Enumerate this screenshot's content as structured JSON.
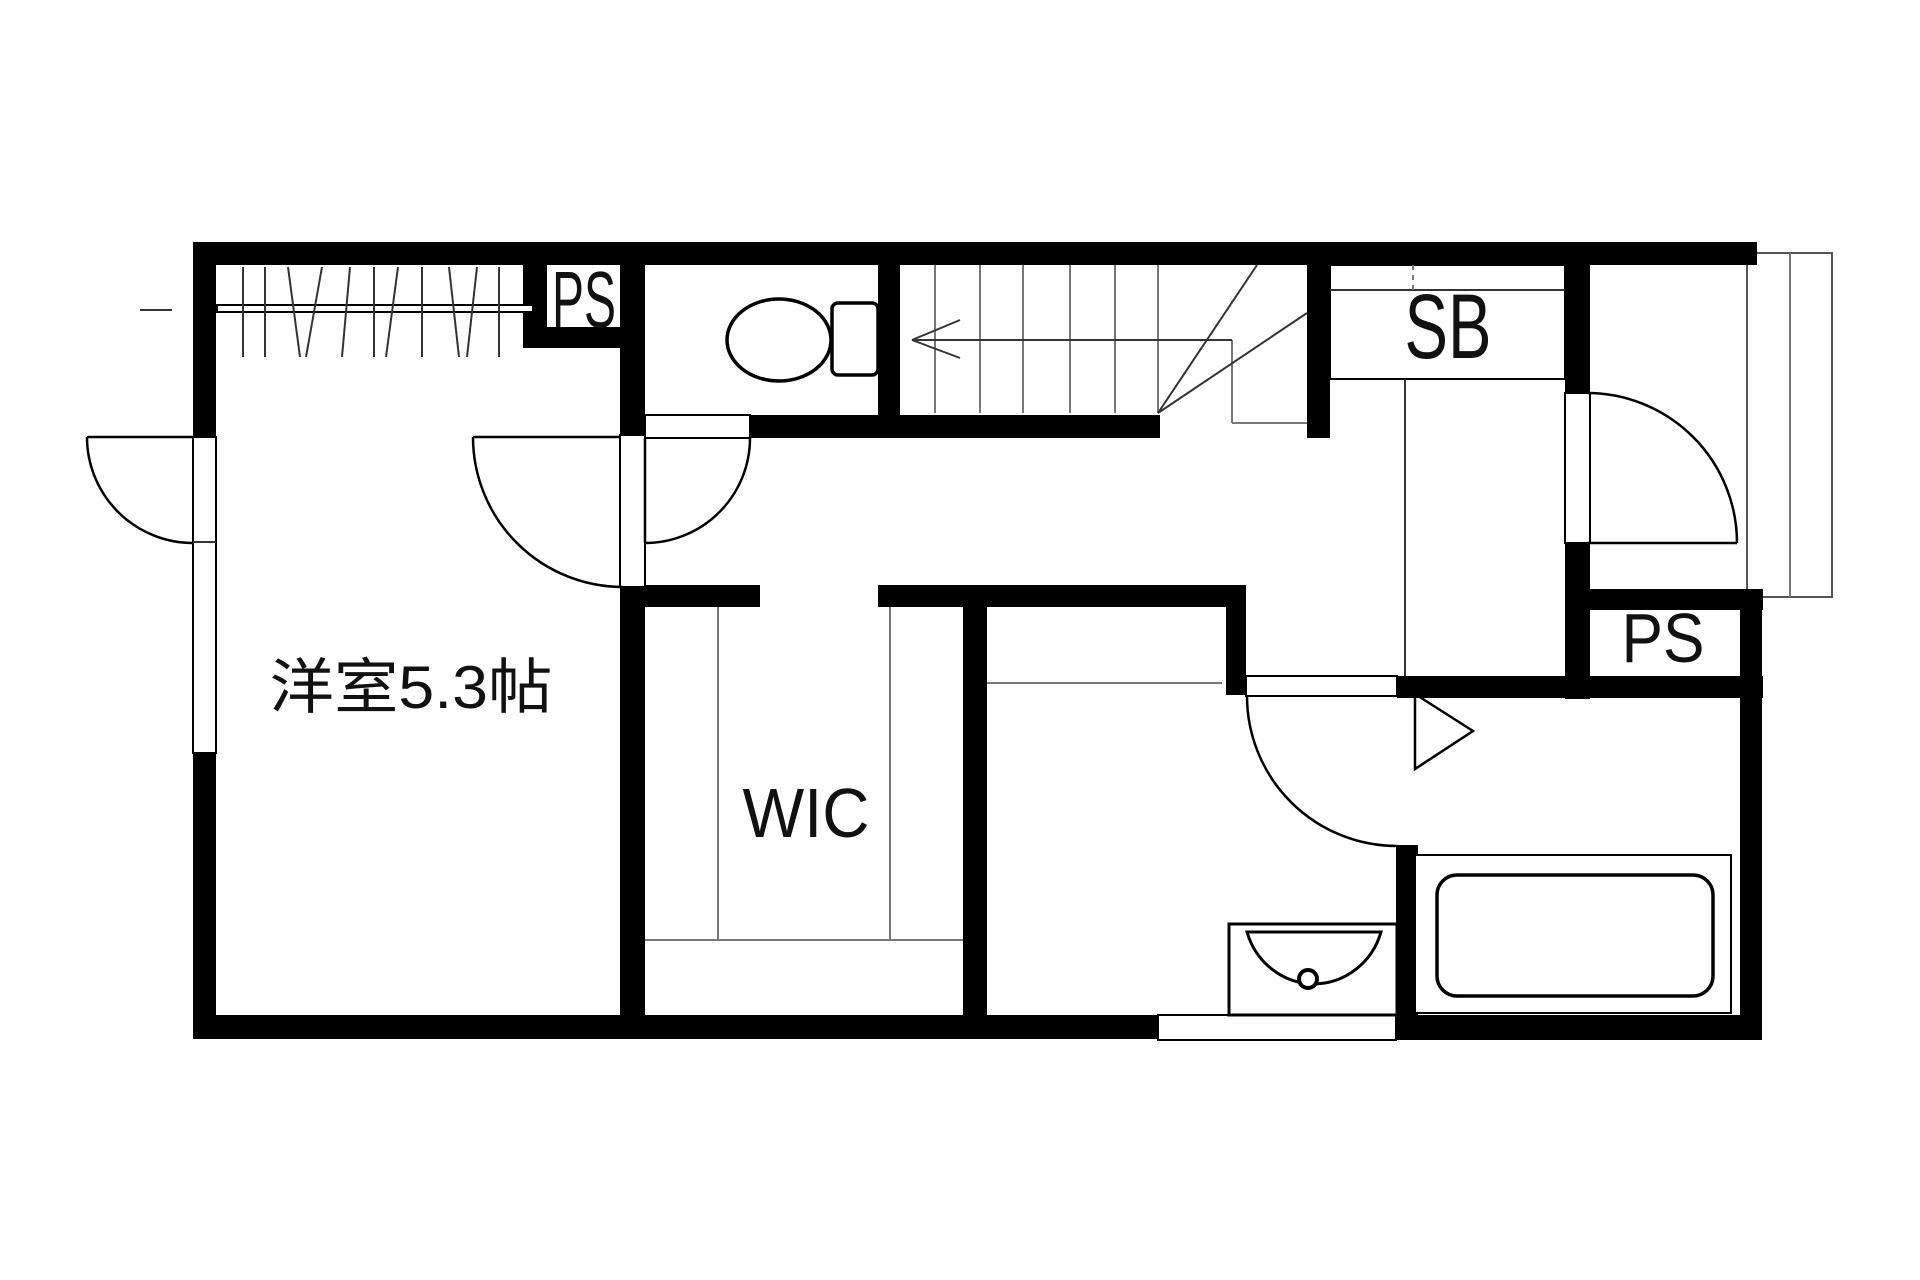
{
  "title": "apartment-floor-plan",
  "colors": {
    "wall": "#000000",
    "background": "#ffffff",
    "thin_line": "#777777",
    "text": "#111111"
  },
  "labels": {
    "main_room": "洋室5.3帖",
    "walk_in_closet": "WIC",
    "pipe_space_top": "PS",
    "pipe_space_right": "PS",
    "shoe_box": "SB"
  }
}
